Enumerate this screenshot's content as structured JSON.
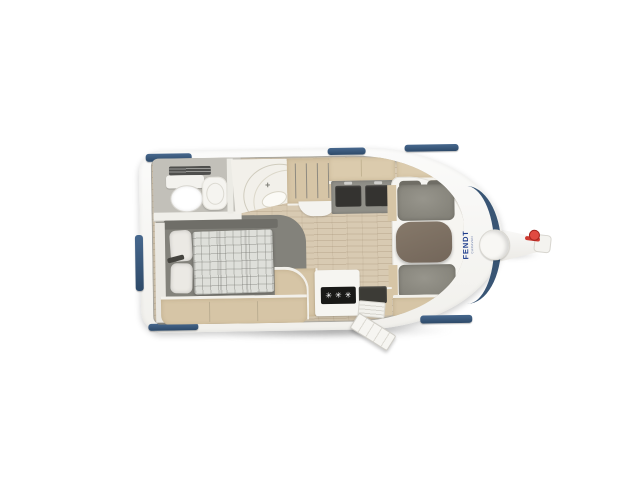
{
  "meta": {
    "description": "Top-down floor plan rendering of a single-axle touring caravan",
    "view": "top-down"
  },
  "branding": {
    "logo": "FENDT",
    "logo_sub": "CARAVAN",
    "logo_color": "#1f3e8e"
  },
  "icons": {
    "burner_glyph": "✳",
    "faucet_glyph": "+",
    "burner_icon": "three-burner-hob",
    "faucet_icon": "washbasin-tap"
  },
  "colors": {
    "body_shell": "#f7f7f5",
    "window_trim": "#3b5a7e",
    "front_band": "#2f4d6e",
    "floor_wood": "#d8cab2",
    "furniture_wood": "#d6c5a6",
    "upholstery": "#8e8c83",
    "table_top": "#7d7063",
    "hob_panel": "#191917",
    "bed_platform": "#83827b",
    "jockey_handle_red": "#cf3a31"
  },
  "fixtures": {
    "rear_washroom": [
      "roof-vent",
      "toilet-with-cistern",
      "washbasin-cabinet",
      "corner-shower-with-tap"
    ],
    "bedroom": [
      "french-bed",
      "pillows",
      "plaid-blanket",
      "bed-frame",
      "side-ledge"
    ],
    "wardrobe": [
      "hanging-rail-with-hangers",
      "curved-shelf"
    ],
    "kitchen": [
      "overhead-locker",
      "worktop-with-storage-bins",
      "three-burner-hob",
      "sink",
      "pull-out-step",
      "base-cabinet"
    ],
    "front_dinette": [
      "rear-bench",
      "front-bench",
      "dinette-table",
      "overhead-locker",
      "wood-trim-bench"
    ],
    "exterior": [
      "entry-door-open",
      "side-window",
      "roof-windows",
      "front-window-band",
      "drawbar",
      "gas-bottle-cover",
      "hitch-coupling",
      "jockey-wheel-handle"
    ]
  }
}
